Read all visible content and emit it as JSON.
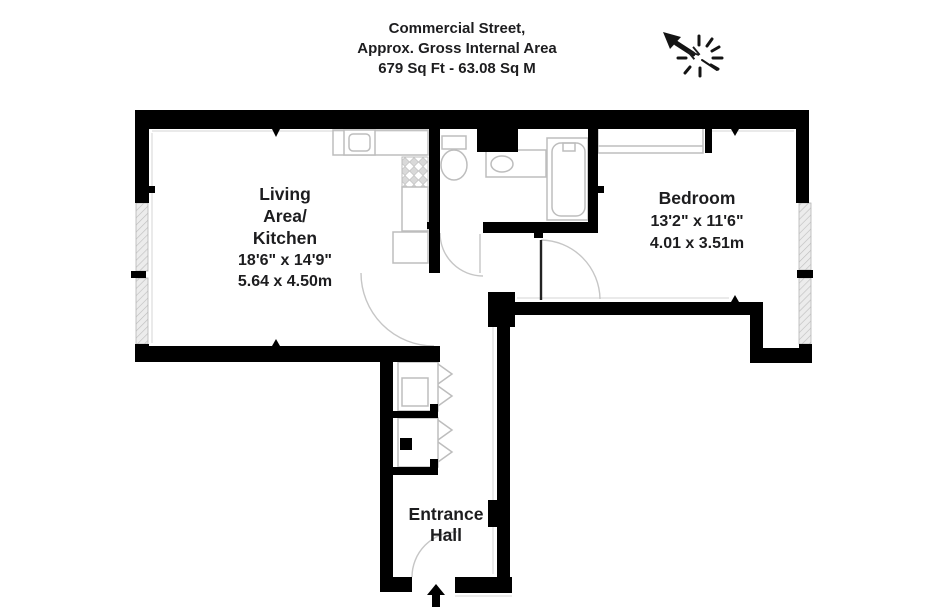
{
  "header": {
    "address": "Commercial Street,",
    "area_label": "Approx. Gross Internal Area",
    "area_value": "679 Sq Ft - 63.08 Sq M"
  },
  "compass": {
    "north_letter": "N"
  },
  "rooms": {
    "living_kitchen": {
      "label_line1": "Living",
      "label_line2": "Area/",
      "label_line3": "Kitchen",
      "dims_imperial": "18'6\" x 14'9\"",
      "dims_metric": "5.64 x 4.50m"
    },
    "bedroom": {
      "label": "Bedroom",
      "dims_imperial": "13'2\" x 11'6\"",
      "dims_metric": "4.01 x 3.51m"
    },
    "entrance_hall": {
      "label_line1": "Entrance",
      "label_line2": "Hall"
    }
  },
  "colors": {
    "wall": "#000000",
    "text": "#1d1d1f",
    "fixture": "#bdbdbd",
    "window-fill": "#ececec",
    "window-stroke": "#b5b5b5"
  }
}
